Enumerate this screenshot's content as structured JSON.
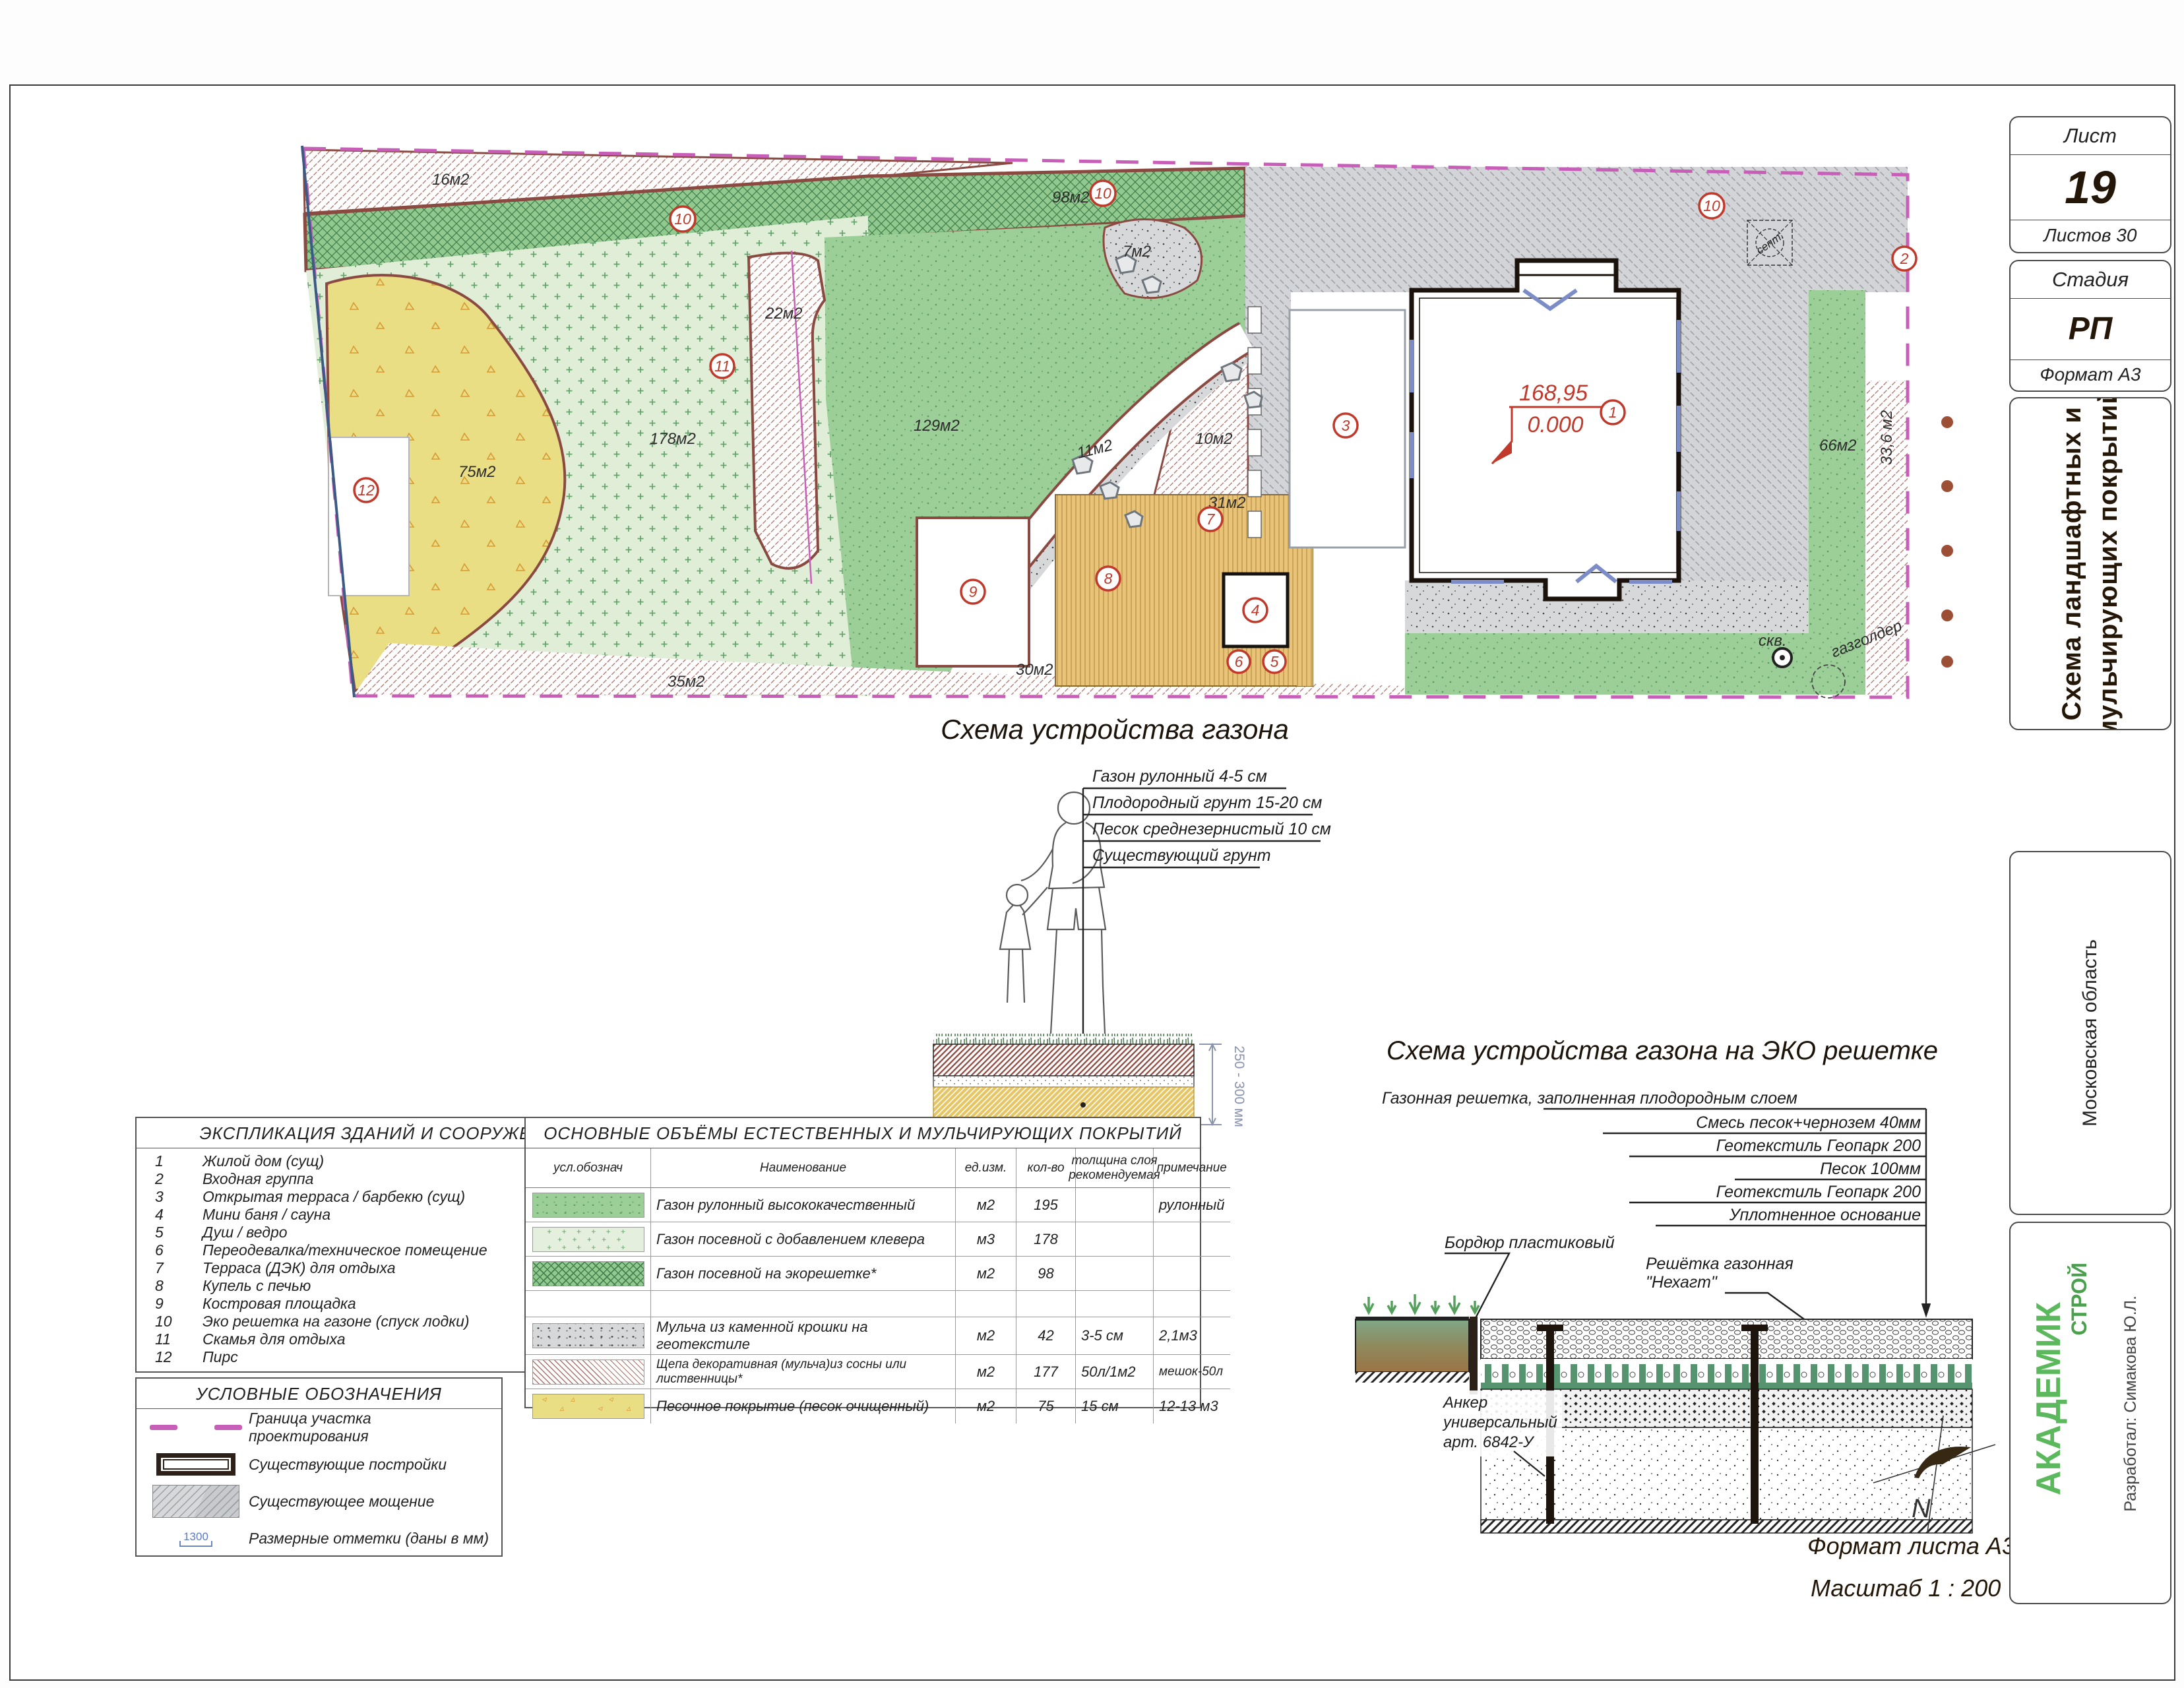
{
  "titleblock": {
    "sheet_label": "Лист",
    "sheet_no": "19",
    "sheets_total": "Листов 30",
    "stage_label": "Стадия",
    "stage": "РП",
    "format": "Формат А3",
    "doc_title_line1": "Схема ландшафтных и",
    "doc_title_line2": "мульчирующих покрытий",
    "region": "Московская область",
    "company_name": "АКАДЕМИК",
    "company_suffix": "СТРОЙ",
    "developer": "Разработал: Симакова Ю.Л."
  },
  "plan": {
    "area_labels": {
      "a16": "16м2",
      "a98": "98м2",
      "a22": "22м2",
      "a129": "129м2",
      "a178": "178м2",
      "a75": "75м2",
      "a11": "11м2",
      "a31": "31м2",
      "a7": "7м2",
      "a10": "10м2",
      "a35": "35м2",
      "a30": "30м2",
      "a66": "66м2",
      "a336": "33,6 м2"
    },
    "callouts": {
      "c1": "1",
      "c2": "2",
      "c3": "3",
      "c4": "4",
      "c5": "5",
      "c6": "6",
      "c7": "7",
      "c8": "8",
      "c9": "9",
      "c10": "10",
      "c11": "11",
      "c12": "12"
    },
    "texts": {
      "septic": "септ.",
      "well": "скв.",
      "gasholder": "газголдер",
      "elev_top": "168,95",
      "elev_bottom": "0.000"
    }
  },
  "scheme_lawn": {
    "title": "Схема устройства газона",
    "layers": [
      "Газон рулонный 4-5 см",
      "Плодородный грунт 15-20 см",
      "Песок среднезернистый 10 см",
      "Существующий грунт"
    ],
    "dimension": "250 - 300 мм"
  },
  "scheme_eco": {
    "title": "Схема устройства газона на ЭКО решетке",
    "layers": [
      "Газонная решетка, заполненная плодородным слоем",
      "Смесь песок+чернозем 40мм",
      "Геотекстиль Геопарк 200",
      "Песок 100мм",
      "Геотекстиль Геопарк 200",
      "Уплотненное основание"
    ],
    "border_label": "Бордюр пластиковый",
    "grid_label1": "Решётка газонная",
    "grid_label2": "\"Нехагт\"",
    "anchor_label1": "Анкер",
    "anchor_label2": "универсальный",
    "anchor_label3": "арт. 6842-У",
    "north_letter": "N",
    "format_note": "Формат листа А3",
    "scale_note": "Масштаб 1 : 200"
  },
  "explication": {
    "title": "ЭКСПЛИКАЦИЯ ЗДАНИЙ И СООРУЖЕНИЙ",
    "rows": [
      {
        "num": "1",
        "name": "Жилой дом (сущ)"
      },
      {
        "num": "2",
        "name": "Входная группа"
      },
      {
        "num": "3",
        "name": "Открытая терраса / барбекю (сущ)"
      },
      {
        "num": "4",
        "name": "Мини баня / сауна"
      },
      {
        "num": "5",
        "name": "Душ / ведро"
      },
      {
        "num": "6",
        "name": "Переодевалка/техническое помещение"
      },
      {
        "num": "7",
        "name": "Терраса (ДЭК) для отдыха"
      },
      {
        "num": "8",
        "name": "Купель с печью"
      },
      {
        "num": "9",
        "name": "Костровая площадка"
      },
      {
        "num": "10",
        "name": "Эко решетка на газоне (спуск лодки)"
      },
      {
        "num": "11",
        "name": "Скамья для отдыха"
      },
      {
        "num": "12",
        "name": "Пирс"
      }
    ]
  },
  "volumes": {
    "title": "ОСНОВНЫЕ ОБЪЁМЫ ЕСТЕСТВЕННЫХ И МУЛЬЧИРУЮЩИХ ПОКРЫТИЙ",
    "headers": {
      "symbol": "усл.обознач",
      "name": "Наименование",
      "unit": "ед.изм.",
      "qty": "кол-во",
      "thickness": "толщина слоя рекомендуемая",
      "note": "примечание"
    },
    "rows": [
      {
        "name": "Газон рулонный высококачественный",
        "unit": "м2",
        "qty": "195",
        "thickness": "",
        "note": "рулонный"
      },
      {
        "name": "Газон посевной с добавлением клевера",
        "unit": "м3",
        "qty": "178",
        "thickness": "",
        "note": ""
      },
      {
        "name": "Газон посевной на экорешетке*",
        "unit": "м2",
        "qty": "98",
        "thickness": "",
        "note": ""
      },
      {
        "name": "",
        "unit": "",
        "qty": "",
        "thickness": "",
        "note": ""
      },
      {
        "name": "Мульча из каменной крошки на геотекстиле",
        "unit": "м2",
        "qty": "42",
        "thickness": "3-5 см",
        "note": "2,1м3"
      },
      {
        "name": "Щепа декоративная (мульча)из сосны или лиственницы*",
        "unit": "м2",
        "qty": "177",
        "thickness": "50л/1м2",
        "note": "мешок-50л"
      },
      {
        "name": "Песочное покрытие (песок очищенный)",
        "unit": "м2",
        "qty": "75",
        "thickness": "15 см",
        "note": "12-13 м3"
      }
    ]
  },
  "legend": {
    "title": "УСЛОВНЫЕ ОБОЗНАЧЕНИЯ",
    "items": [
      {
        "label": "Граница участка проектирования"
      },
      {
        "label": "Существующие постройки"
      },
      {
        "label": "Существующее мощение"
      },
      {
        "label": "Размерные отметки (даны в мм)",
        "value": "1300"
      }
    ]
  },
  "colors": {
    "boundary_magenta": "#c75fb8",
    "callout_red": "#c0392b",
    "company_green": "#5cb85c",
    "eco_green": "#92c98f",
    "rolled_green": "#9ccf98",
    "clover_green": "#e4f0dd",
    "sand_yellow": "#eade85",
    "paving_gray": "#d2d4d7",
    "deck_tan": "#e9c478"
  }
}
